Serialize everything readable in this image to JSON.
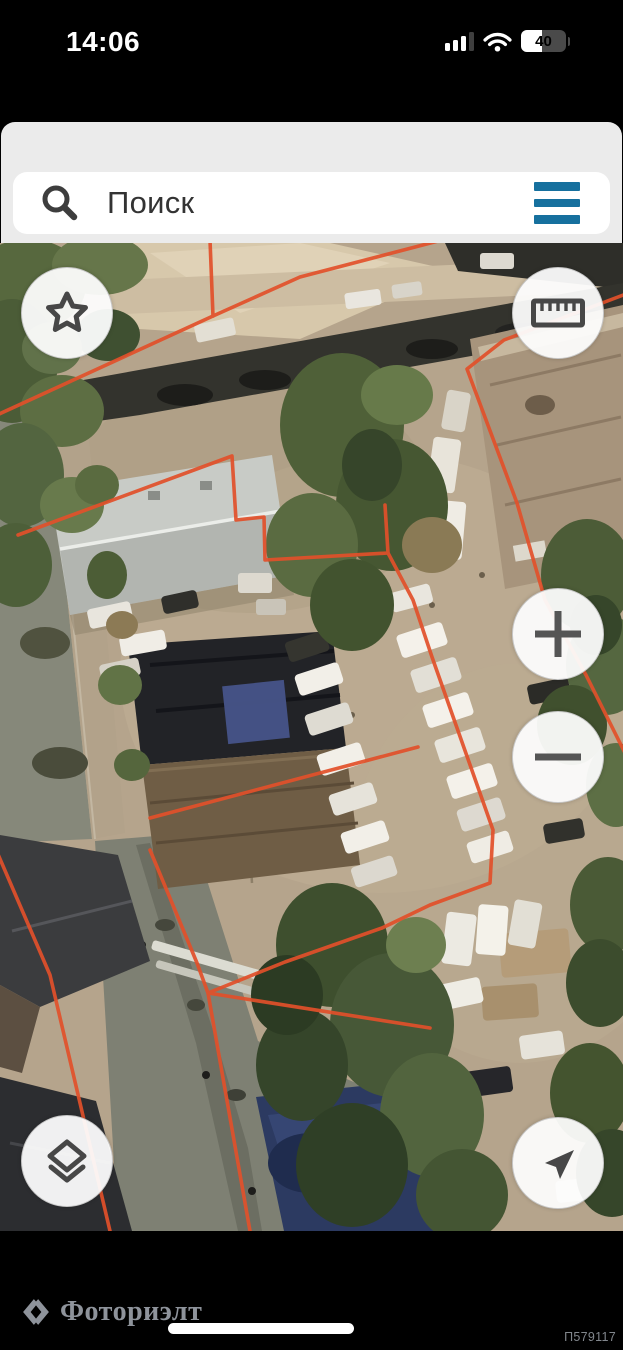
{
  "status_bar": {
    "time": "14:06",
    "battery_percent": "40",
    "signal_icon": "cellular-signal-icon",
    "wifi_icon": "wifi-icon",
    "battery_icon": "battery-icon"
  },
  "search_bar": {
    "placeholder": "Поиск",
    "search_icon": "magnifier-icon",
    "menu_icon": "hamburger-menu-icon",
    "menu_color": "#16709e"
  },
  "map": {
    "view_type": "satellite-aerial",
    "boundary_color": "#e2502a",
    "controls": [
      {
        "name": "favorites",
        "icon": "star-icon",
        "position": "top-left"
      },
      {
        "name": "measure",
        "icon": "ruler-icon",
        "position": "top-right"
      },
      {
        "name": "zoom-in",
        "icon": "plus-icon",
        "position": "right-middle"
      },
      {
        "name": "zoom-out",
        "icon": "minus-icon",
        "position": "right-middle"
      },
      {
        "name": "layers",
        "icon": "layers-icon",
        "position": "bottom-left"
      },
      {
        "name": "my-location",
        "icon": "location-arrow-icon",
        "position": "bottom-right"
      }
    ]
  },
  "footer": {
    "watermark": "Фоториэлт",
    "watermark_icon": "fotorielt-logo-icon",
    "listing_id": "П579117"
  }
}
